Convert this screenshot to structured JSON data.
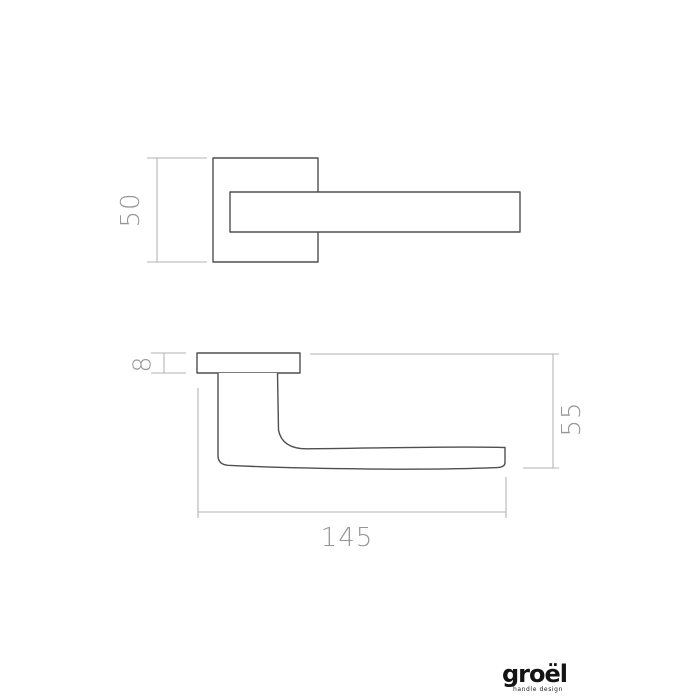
{
  "document": {
    "type": "technical-drawing"
  },
  "colors": {
    "background": "#ffffff",
    "object_line": "#4f4f4f",
    "dimension_line": "#b3b3b3",
    "dimension_text": "#969696",
    "logo_text": "#141414"
  },
  "dimensions": {
    "rose_size": {
      "value": "50"
    },
    "rose_thickness": {
      "value": "8"
    },
    "handle_projection": {
      "value": "55"
    },
    "overall_length": {
      "value": "145"
    }
  },
  "logo": {
    "wordmark": "groël",
    "tagline": "handle design"
  }
}
